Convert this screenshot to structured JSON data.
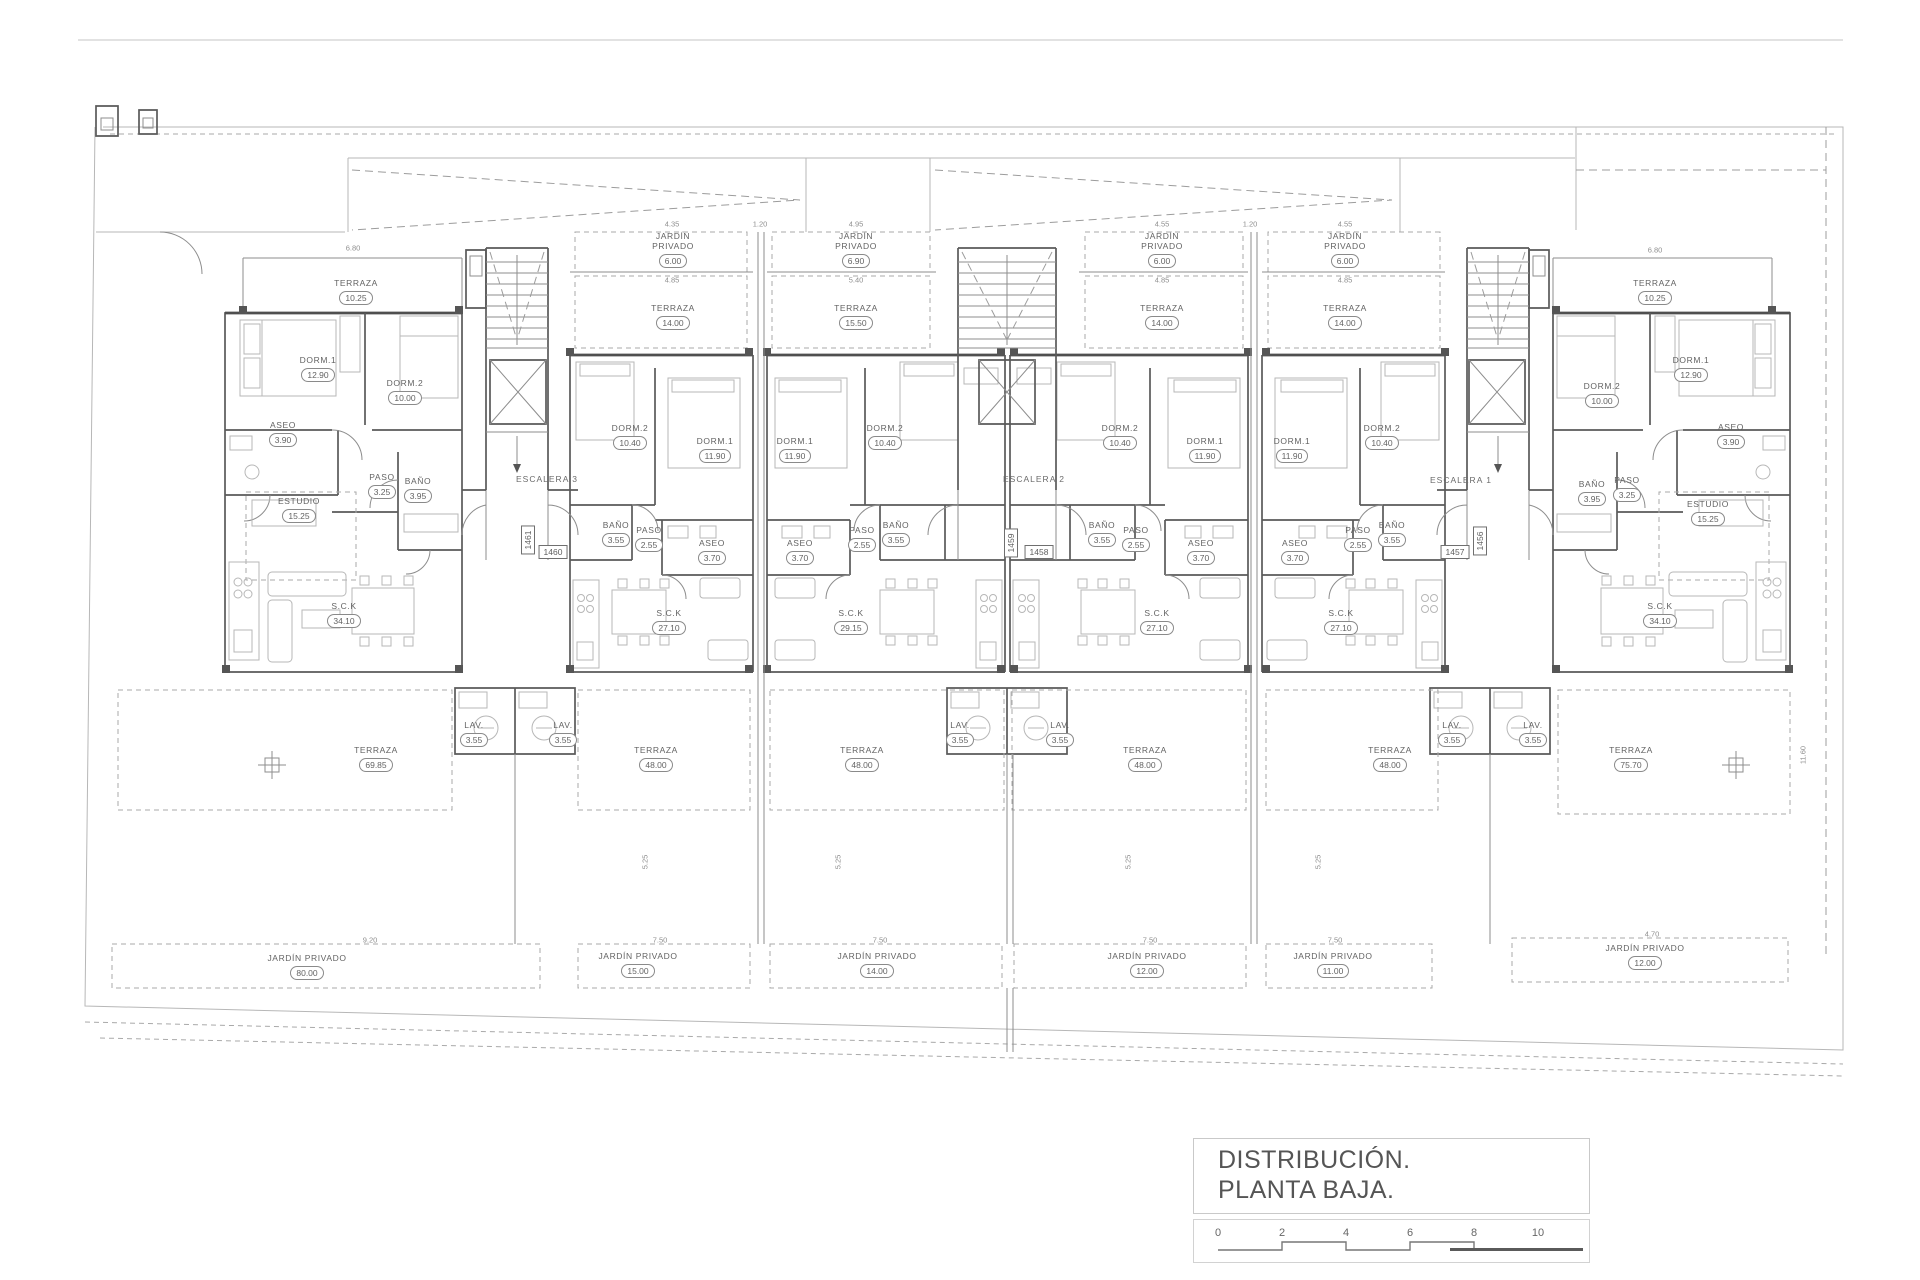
{
  "drawing": {
    "type": "architectural floor plan",
    "language": "es"
  },
  "title_block": {
    "line1": "DISTRIBUCIÓN.",
    "line2": "PLANTA BAJA.",
    "scale_ticks": [
      "0",
      "2",
      "4",
      "6",
      "8",
      "10"
    ]
  },
  "stairwells": [
    {
      "label": "ESCALERA 3"
    },
    {
      "label": "ESCALERA 2"
    },
    {
      "label": "ESCALERA 1"
    }
  ],
  "unit_numbers": {
    "horizontal": [
      "1460",
      "1458",
      "1457"
    ],
    "vertical": [
      "1461",
      "1459",
      "1456"
    ]
  },
  "rooms": [
    {
      "name": "TERRAZA",
      "area": "10.25"
    },
    {
      "name": "DORM.1",
      "area": "12.90"
    },
    {
      "name": "DORM.2",
      "area": "10.00"
    },
    {
      "name": "ASEO",
      "area": "3.90"
    },
    {
      "name": "PASO",
      "area": "3.25"
    },
    {
      "name": "BAÑO",
      "area": "3.95"
    },
    {
      "name": "ESTUDIO",
      "area": "15.25"
    },
    {
      "name": "S.C.K",
      "area": "34.10"
    },
    {
      "name": "LAV.",
      "area": "3.55"
    },
    {
      "name": "TERRAZA",
      "area": "69.85"
    },
    {
      "name": "JARDÍN PRIVADO",
      "area": "80.00"
    },
    {
      "name": "JARDÍN PRIVADO",
      "area": "6.00"
    },
    {
      "name": "TERRAZA",
      "area": "14.00"
    },
    {
      "name": "DORM.2",
      "area": "10.40"
    },
    {
      "name": "DORM.1",
      "area": "11.90"
    },
    {
      "name": "BAÑO",
      "area": "3.55"
    },
    {
      "name": "PASO",
      "area": "2.55"
    },
    {
      "name": "ASEO",
      "area": "3.70"
    },
    {
      "name": "S.C.K",
      "area": "27.10"
    },
    {
      "name": "LAV.",
      "area": "3.55"
    },
    {
      "name": "TERRAZA",
      "area": "48.00"
    },
    {
      "name": "JARDÍN PRIVADO",
      "area": "15.00"
    },
    {
      "name": "JARDÍN PRIVADO",
      "area": "6.90"
    },
    {
      "name": "TERRAZA",
      "area": "15.50"
    },
    {
      "name": "DORM.1",
      "area": "11.90"
    },
    {
      "name": "DORM.2",
      "area": "10.40"
    },
    {
      "name": "ASEO",
      "area": "3.70"
    },
    {
      "name": "PASO",
      "area": "2.55"
    },
    {
      "name": "BAÑO",
      "area": "3.55"
    },
    {
      "name": "S.C.K",
      "area": "29.15"
    },
    {
      "name": "LAV.",
      "area": "3.55"
    },
    {
      "name": "TERRAZA",
      "area": "48.00"
    },
    {
      "name": "JARDÍN PRIVADO",
      "area": "14.00"
    },
    {
      "name": "JARDÍN PRIVADO",
      "area": "6.00"
    },
    {
      "name": "TERRAZA",
      "area": "14.00"
    },
    {
      "name": "DORM.2",
      "area": "10.40"
    },
    {
      "name": "DORM.1",
      "area": "11.90"
    },
    {
      "name": "BAÑO",
      "area": "3.55"
    },
    {
      "name": "PASO",
      "area": "2.55"
    },
    {
      "name": "ASEO",
      "area": "3.70"
    },
    {
      "name": "S.C.K",
      "area": "27.10"
    },
    {
      "name": "LAV.",
      "area": "3.55"
    },
    {
      "name": "TERRAZA",
      "area": "48.00"
    },
    {
      "name": "JARDÍN PRIVADO",
      "area": "12.00"
    },
    {
      "name": "JARDÍN PRIVADO",
      "area": "6.00"
    },
    {
      "name": "TERRAZA",
      "area": "14.00"
    },
    {
      "name": "DORM.1",
      "area": "11.90"
    },
    {
      "name": "DORM.2",
      "area": "10.40"
    },
    {
      "name": "ASEO",
      "area": "3.70"
    },
    {
      "name": "PASO",
      "area": "2.55"
    },
    {
      "name": "BAÑO",
      "area": "3.55"
    },
    {
      "name": "S.C.K",
      "area": "27.10"
    },
    {
      "name": "LAV.",
      "area": "3.55"
    },
    {
      "name": "TERRAZA",
      "area": "48.00"
    },
    {
      "name": "JARDÍN PRIVADO",
      "area": "11.00"
    },
    {
      "name": "TERRAZA",
      "area": "10.25"
    },
    {
      "name": "DORM.2",
      "area": "10.00"
    },
    {
      "name": "DORM.1",
      "area": "12.90"
    },
    {
      "name": "ASEO",
      "area": "3.90"
    },
    {
      "name": "PASO",
      "area": "3.25"
    },
    {
      "name": "BAÑO",
      "area": "3.95"
    },
    {
      "name": "ESTUDIO",
      "area": "15.25"
    },
    {
      "name": "S.C.K",
      "area": "34.10"
    },
    {
      "name": "LAV.",
      "area": "3.55"
    },
    {
      "name": "TERRAZA",
      "area": "75.70"
    },
    {
      "name": "JARDÍN PRIVADO",
      "area": "12.00"
    }
  ],
  "dimensions": [
    "6.80",
    "4.35",
    "1.20",
    "4.95",
    "4.85",
    "5.40",
    "4.55",
    "1.20",
    "4.55",
    "4.85",
    "4.85",
    "6.80",
    "9.20",
    "7.50",
    "7.50",
    "7.50",
    "7.50",
    "4.70",
    "5.25",
    "5.25",
    "5.25",
    "5.25",
    "11.60"
  ]
}
